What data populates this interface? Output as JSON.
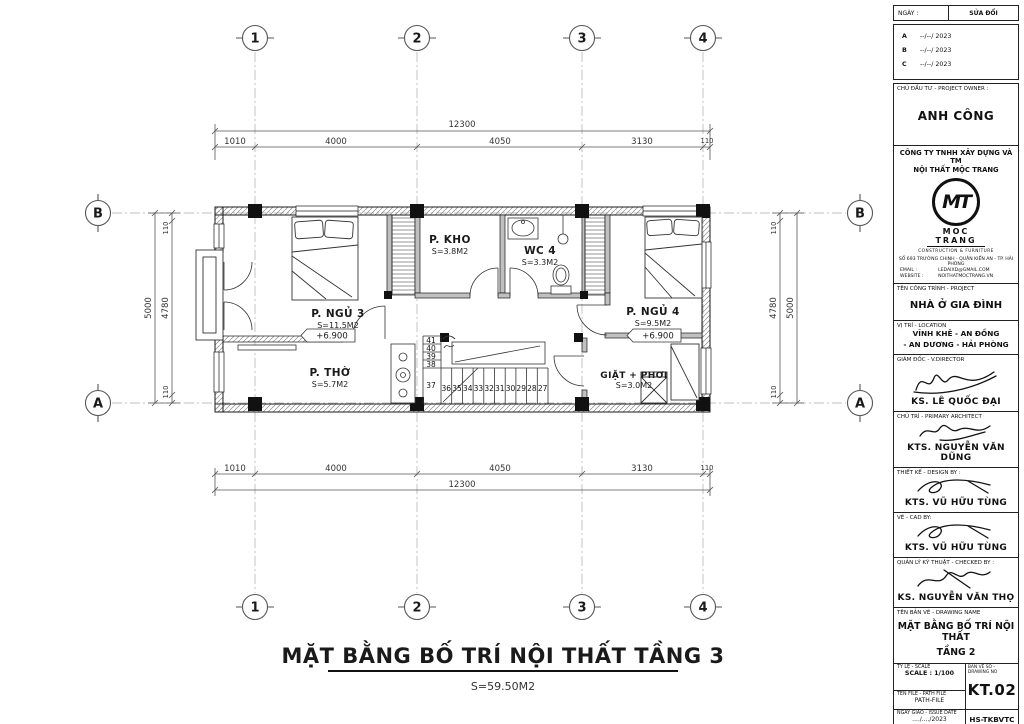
{
  "drawing": {
    "title": "MẶT BẰNG BỐ TRÍ NỘI THẤT TẦNG 3",
    "total_area": "S=59.50M2",
    "grid": {
      "cols": [
        "1",
        "2",
        "3",
        "4"
      ],
      "rows": [
        "A",
        "B"
      ]
    },
    "dims": {
      "overall": "12300",
      "segments": [
        "1010",
        "4000",
        "4050",
        "3130",
        "110"
      ],
      "side_outer": "5000",
      "side_inner": "4780",
      "side_end": "110"
    },
    "rooms": {
      "ngu3": {
        "name": "P. NGỦ 3",
        "area": "S=11.5M2",
        "level": "+6.900"
      },
      "kho": {
        "name": "P. KHO",
        "area": "S=3.8M2"
      },
      "wc4": {
        "name": "WC 4",
        "area": "S=3.3M2"
      },
      "ngu4": {
        "name": "P. NGỦ 4",
        "area": "S=9.5M2",
        "level": "+6.900"
      },
      "tho": {
        "name": "P. THỜ",
        "area": "S=5.7M2"
      },
      "giat": {
        "name": "GIẶT + PHƠI",
        "area": "S=3.0M2"
      }
    },
    "stairs": {
      "down_numbers": [
        "41",
        "40",
        "39",
        "38",
        "37"
      ],
      "run_numbers": [
        "36",
        "35",
        "34",
        "33",
        "32",
        "31",
        "30",
        "29",
        "28",
        "27"
      ]
    }
  },
  "titleblock": {
    "revision": {
      "date_label": "NGÀY :",
      "change_label": "SỬA ĐỔI",
      "rows": [
        {
          "key": "A",
          "value": "--/--/ 2023"
        },
        {
          "key": "B",
          "value": "--/--/ 2023"
        },
        {
          "key": "C",
          "value": "--/--/ 2023"
        }
      ]
    },
    "owner": {
      "label": "CHỦ ĐẦU TƯ - PROJECT OWNER :",
      "name": "ANH CÔNG"
    },
    "company": {
      "name_line1": "CÔNG TY TNHH XÂY DỰNG VÀ TM",
      "name_line2": "NỘI THẤT MỘC TRANG",
      "logo_text": "MT",
      "logo_name": "MOC TRANG",
      "logo_sub": "CONSTRUCTION & FURNITURE",
      "address": "SỐ 693 TRƯỜNG CHINH - QUẬN KIẾN AN - TP. HẢI PHÒNG",
      "email_label": "EMAIL :",
      "email": "LEDAIXD@GMAIL.COM",
      "website_label": "WEBSITE :",
      "website": "NOITHATMOCTRANG.VN"
    },
    "project": {
      "label": "TÊN CÔNG TRÌNH - PROJECT",
      "name": "NHÀ Ở GIA ĐÌNH"
    },
    "location": {
      "label": "VỊ TRÍ - LOCATION",
      "line1": "VĨNH KHÊ - AN ĐỒNG",
      "line2": "- AN DƯƠNG - HẢI PHÒNG"
    },
    "signers": [
      {
        "label": "GIÁM ĐỐC - V.DIRECTOR",
        "name": "KS. LÊ QUỐC ĐẠI"
      },
      {
        "label": "CHỦ TRÌ - PRIMARY ARCHITECT",
        "name": "KTS. NGUYỄN VĂN DŨNG"
      },
      {
        "label": "THIẾT KẾ - DESIGN BY :",
        "name": "KTS. VŨ HỮU TÙNG"
      },
      {
        "label": "VẼ - CAD BY:",
        "name": "KTS. VŨ HỮU TÙNG"
      },
      {
        "label": "QUẢN LÝ KỸ THUẬT - CHECKED BY :",
        "name": "KS. NGUYỄN VĂN THỌ"
      }
    ],
    "drawing_name": {
      "label": "TÊN BẢN VẼ - DRAWING NAME",
      "line1": "MẶT BẰNG BỐ TRÍ NỘI THẤT",
      "line2": "TẦNG 2"
    },
    "footer": {
      "scale_label": "TỶ LỆ - SCALE",
      "scale": "SCALE : 1/100",
      "file_label": "TÊN FILE - PATH FILE",
      "file": "PATH-FILE",
      "date_label": "NGÀY GIAO - ISSUE DATE",
      "date": "..../..../2023",
      "no_label": "BẢN VẼ SỐ - DRAWING NO",
      "no": "KT.02",
      "code": "HS-TKBVTC"
    }
  }
}
